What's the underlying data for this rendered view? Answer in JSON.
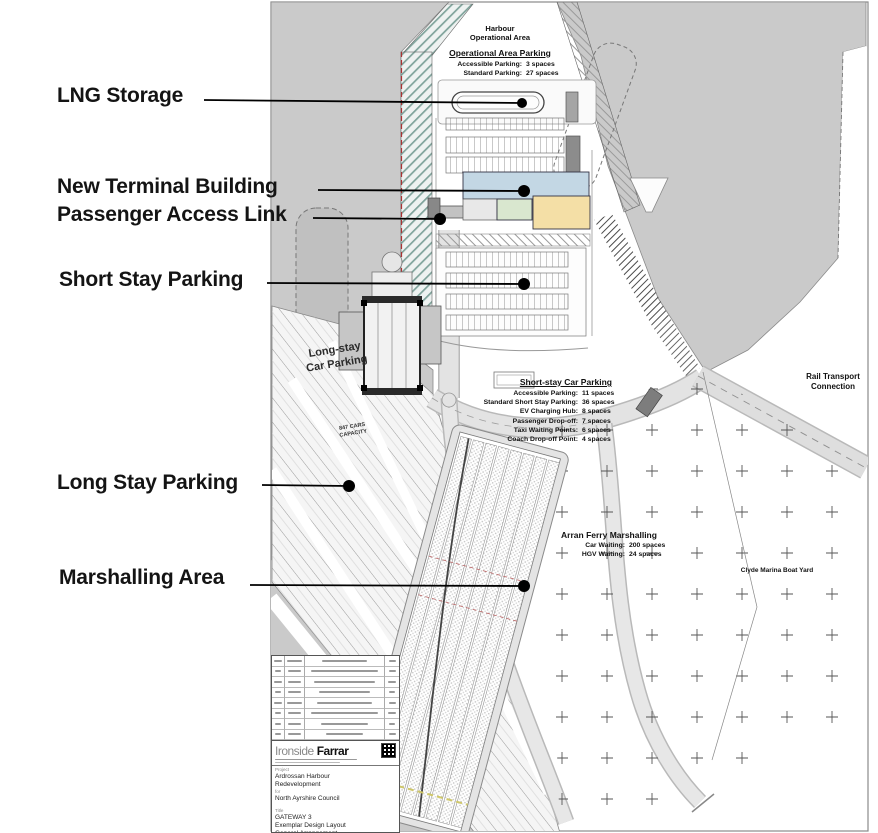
{
  "annotations": {
    "items": [
      {
        "label": "LNG Storage"
      },
      {
        "label": "New Terminal Building"
      },
      {
        "label": "Passenger Access Link"
      },
      {
        "label": "Short Stay Parking"
      },
      {
        "label": "Long Stay Parking"
      },
      {
        "label": "Marshalling Area"
      }
    ]
  },
  "map": {
    "harbour_area": {
      "line1": "Harbour",
      "line2": "Operational Area"
    },
    "operational_parking": {
      "title": "Operational Area Parking",
      "rows": [
        {
          "label": "Accessible Parking:",
          "value": "3 spaces"
        },
        {
          "label": "Standard Parking:",
          "value": "27 spaces"
        }
      ]
    },
    "short_stay": {
      "title": "Short-stay Car Parking",
      "rows": [
        {
          "label": "Accessible Parking:",
          "value": "11 spaces"
        },
        {
          "label": "Standard Short Stay Parking:",
          "value": "36 spaces"
        },
        {
          "label": "EV Charging Hub:",
          "value": "8 spaces"
        },
        {
          "label": "Passenger Drop-off:",
          "value": "7 spaces"
        },
        {
          "label": "Taxi Waiting Points:",
          "value": "6 spaces"
        },
        {
          "label": "Coach Drop-off Point:",
          "value": "4 spaces"
        }
      ]
    },
    "marshalling": {
      "title": "Arran Ferry Marshalling",
      "rows": [
        {
          "label": "Car Waiting:",
          "value": "200 spaces"
        },
        {
          "label": "HGV Waiting:",
          "value": "24 spaces"
        }
      ]
    },
    "long_stay": {
      "line1": "Long-stay",
      "line2": "Car Parking",
      "capacity_line1": "847 CARS",
      "capacity_line2": "CAPACITY"
    },
    "rail": {
      "line1": "Rail Transport",
      "line2": "Connection"
    },
    "clyde_label": "Clyde Marina Boat Yard"
  },
  "title_block": {
    "logo_light": "Ironside",
    "logo_bold": "Farrar",
    "project_label": "Project",
    "project_line1": "Ardrossan Harbour",
    "project_line2": "Redevelopment",
    "client_prefix": "for",
    "client": "North Ayrshire Council",
    "drawing_label": "Title",
    "drawing_line1": "GATEWAY 3",
    "drawing_line2": "Exemplar Design Layout",
    "drawing_line3": "General Arrangement",
    "scale_label": "Scale",
    "scale_value": "1:500"
  },
  "colors": {
    "water": "#cacaca",
    "terminal_blue": "#c3d7e4",
    "terminal_green": "#d9e7cf",
    "terminal_tan": "#f4dfa6",
    "leader": "#000000"
  }
}
